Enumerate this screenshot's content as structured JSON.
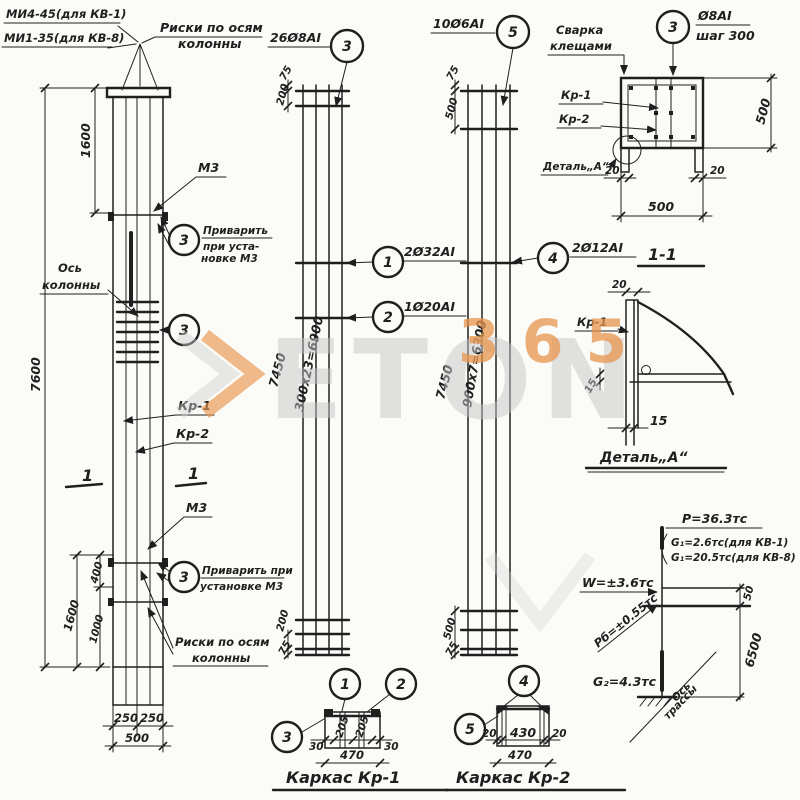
{
  "colors": {
    "ink": "#1f1f1f",
    "watermark_orange": "#e8954d",
    "watermark_gray": "#c6c6c6",
    "paper": "#fbfbf8"
  },
  "watermark": {
    "word": "ETON",
    "num": "365"
  },
  "labels": {
    "mi1": "МИ4-45(для КВ-1)",
    "mi2": "МИ1-35(для КВ-8)",
    "riski1": "Риски по осям",
    "riski2": "колонны",
    "os1": "Ось",
    "os2": "колонны",
    "m3": "М3",
    "weld1a": "Приварить",
    "weld1b": "при уста-",
    "weld1c": "новке М3",
    "weld2a": "Приварить при",
    "weld2b": "установке М3",
    "kr1": "Кр-1",
    "kr2": "Кр-2",
    "svarka1": "Сварка",
    "svarka2": "клещами",
    "detail_a": "Деталь„А“",
    "s11": "1-1",
    "karkas1": "Каркас Кр-1",
    "karkas2": "Каркас Кр-2",
    "mark1": "1",
    "axis1": "Ось",
    "axis2": "трассы"
  },
  "positions": {
    "p1": "1",
    "p2": "2",
    "p3": "3",
    "p4": "4",
    "p5": "5"
  },
  "callouts": {
    "cage1": "26Ø8АI",
    "cage2": "10Ø6АI",
    "bar1": "2Ø32АI",
    "bar2": "1Ø20АI",
    "bar4": "2Ø12АI",
    "tie1": "Ø8АI",
    "tie2": "шаг 300"
  },
  "loads": {
    "p": "Р=36.3тс",
    "g1a": "G₁=2.6тс(для КВ-1)",
    "g1b": "G₁=20.5тс(для КВ-8)",
    "w": "W=±3.6тс",
    "pb": "Рб=±0.55тс",
    "g2": "G₂=4.3тс"
  },
  "dims": {
    "col_top": "1600",
    "col_total": "7600",
    "col_b1600": "1600",
    "col_b400": "400",
    "col_b1000": "1000",
    "col_250a": "250",
    "col_250b": "250",
    "col_500": "500",
    "c1_t75": "75",
    "c1_t200": "200",
    "c1_total": "7450",
    "c1_run": "300х23=6900",
    "c1_b200": "200",
    "c1_b75": "75",
    "c2_t75": "75",
    "c2_t500": "500",
    "c2_total": "7450",
    "c2_run": "900х7=6300",
    "c2_b500": "500",
    "c2_b75": "75",
    "s11_20l": "20",
    "s11_20r": "20",
    "s11_500w": "500",
    "s11_500h": "500",
    "det_20": "20",
    "det_15a": "15",
    "det_15b": "15",
    "ld_50": "50",
    "ld_6500": "6500",
    "k1_30a": "30",
    "k1_205a": "205",
    "k1_205b": "205",
    "k1_30b": "30",
    "k1_470": "470",
    "k2_20a": "20",
    "k2_430": "430",
    "k2_20b": "20",
    "k2_470": "470"
  }
}
